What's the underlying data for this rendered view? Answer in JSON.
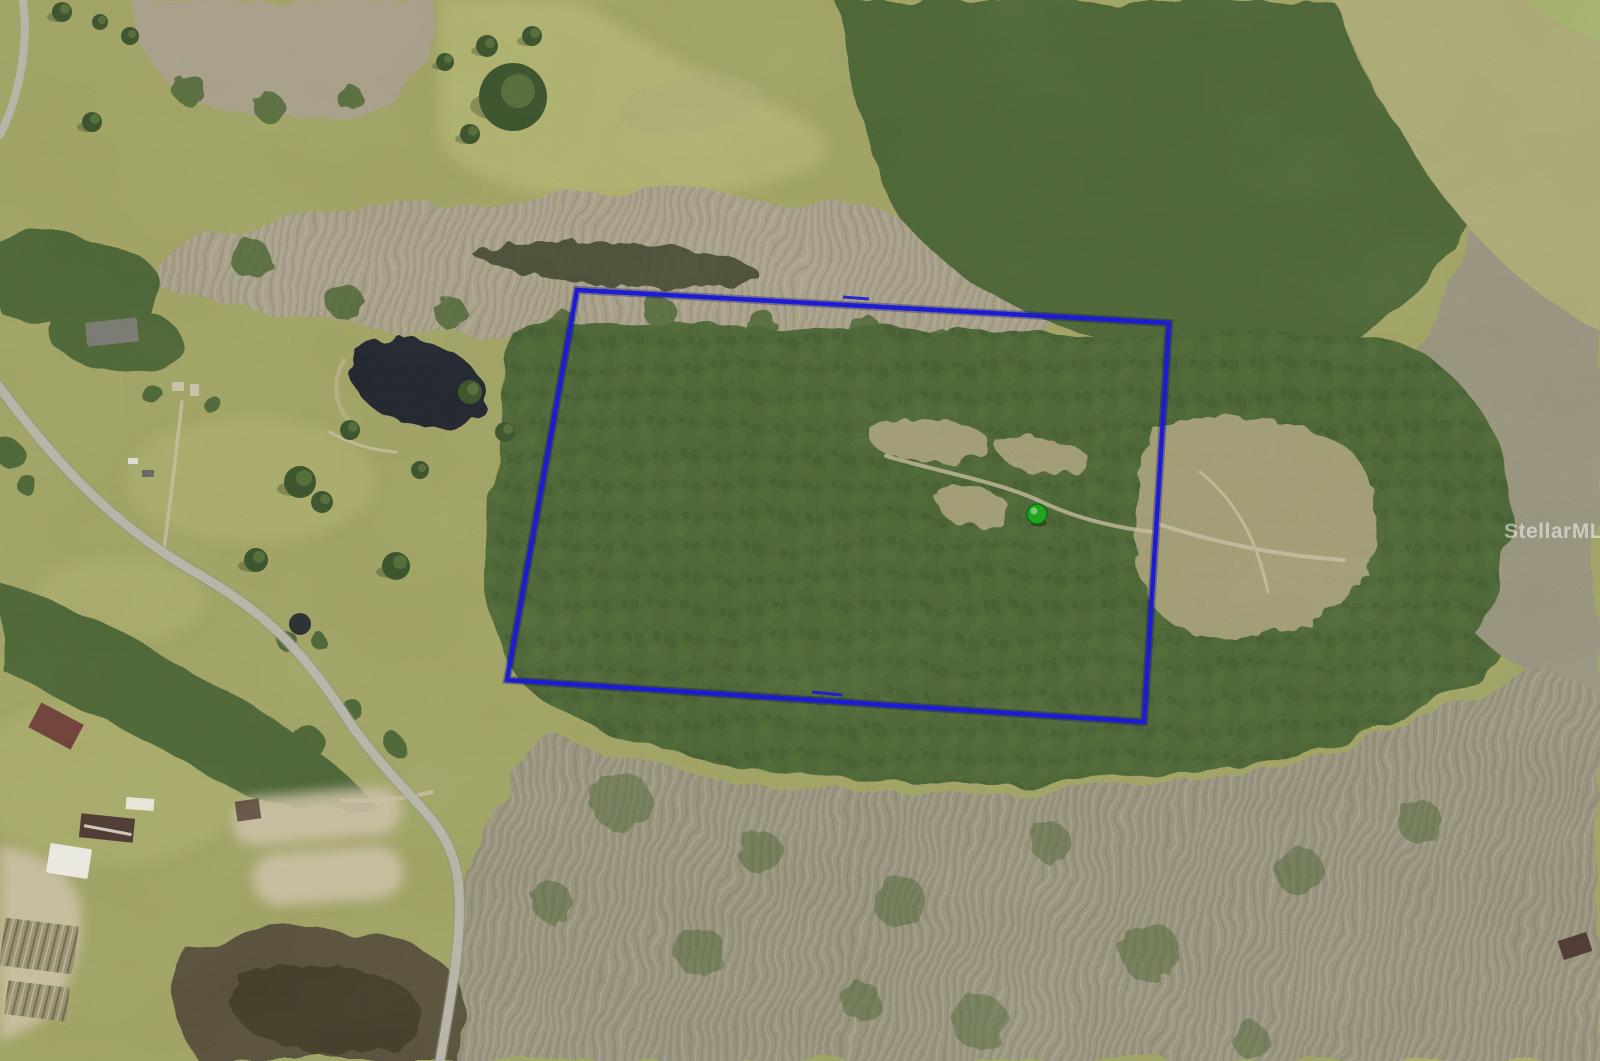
{
  "map": {
    "description": "Aerial photo of rural wooded acreage with blue parcel outline and listing watermark",
    "watermark": {
      "text": "StellarMLS",
      "color": "#ffffff",
      "opacity": 0.5
    },
    "parcel": {
      "color": "#1c1cd6",
      "halo_color": "#000066",
      "width": 4.5,
      "points": "577,290 1169,323 1144,722 507,680"
    },
    "marker": {
      "transform": "translate(1037,514)",
      "r": 10,
      "color": "#1fa51f",
      "edge": "#0b6d10"
    },
    "palette": {
      "grass": "#9da061",
      "grass_light": "#acae6c",
      "grass_bright": "#9fb269",
      "field_tan": "#a9a772",
      "clearing": "#a59e74",
      "forest": "#4c6434",
      "forest_dark": "#3a512b",
      "pale_trees": "#a49c84",
      "dead_forest": "#95907a",
      "swamp": "#40442e",
      "pond": "#20252e",
      "marsh": "#57503a",
      "marsh_dark": "#423c29",
      "road": "#b4b1a4",
      "road_edge": "#8f8d80",
      "sand": "#c9bda2",
      "house_white": "#e9e7df",
      "house_gray": "#75746d",
      "roof_dark": "#4c3a32",
      "roof_red": "#6b4038"
    }
  }
}
